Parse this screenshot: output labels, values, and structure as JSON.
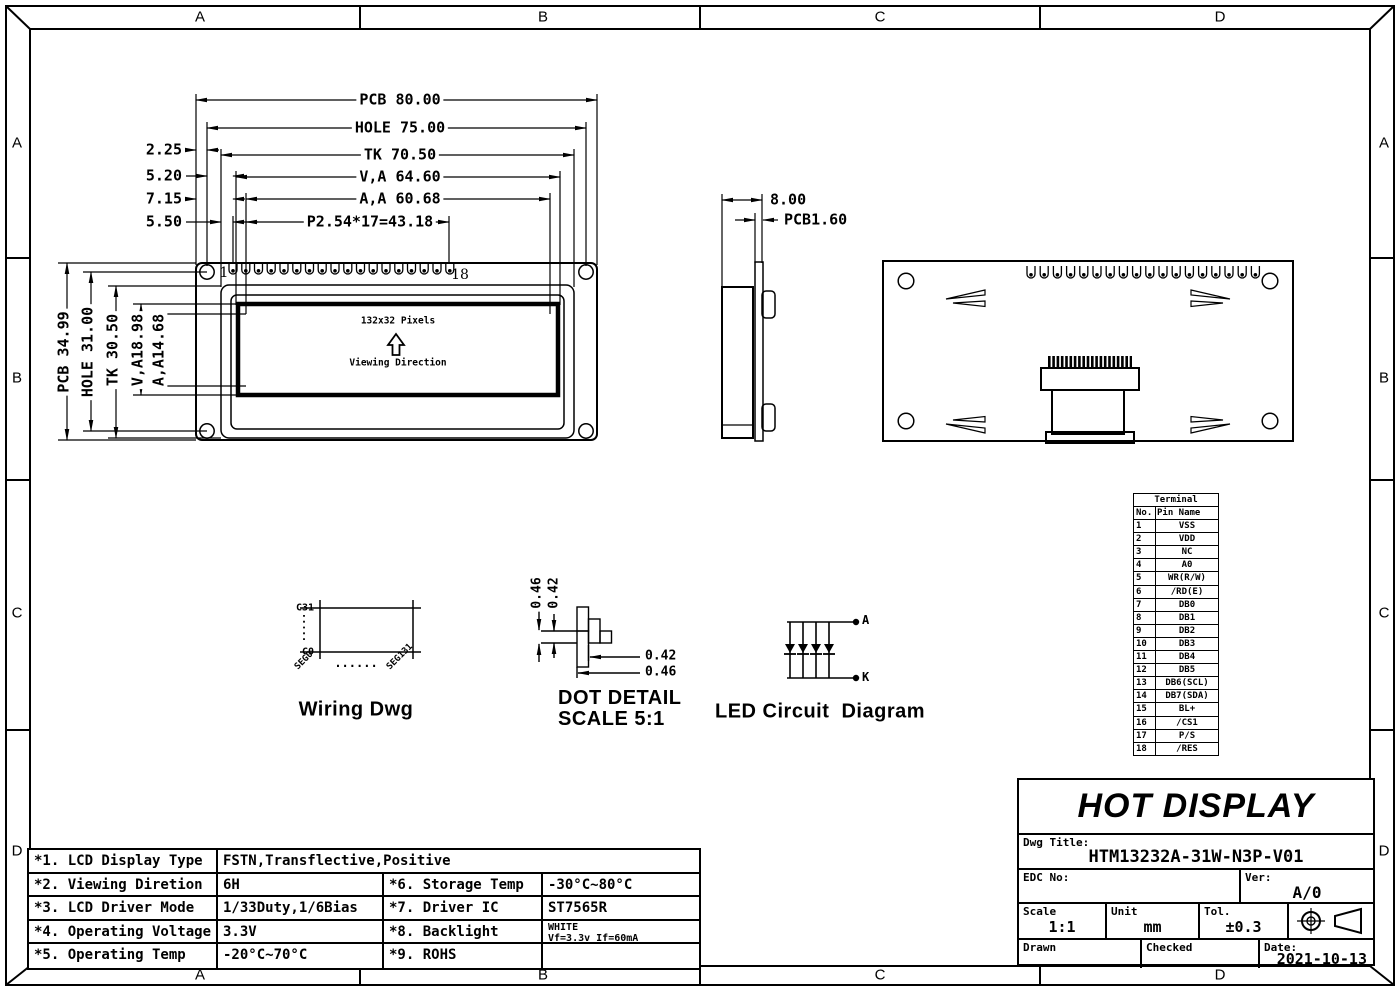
{
  "zones": {
    "top": [
      "A",
      "B",
      "C",
      "D"
    ],
    "bottom": [
      "A",
      "B",
      "C",
      "D"
    ],
    "left": [
      "A",
      "B",
      "C",
      "D"
    ],
    "right": [
      "A",
      "B",
      "C",
      "D"
    ]
  },
  "front_view": {
    "dim_pcb_w": "PCB 80.00",
    "dim_hole_w": "HOLE 75.00",
    "dim_tk_w": "TK 70.50",
    "dim_va_w": "V,A 64.60",
    "dim_aa_w": "A,A 60.68",
    "dim_pitch": "P2.54*17=43.18",
    "offset_1": "2.25",
    "offset_2": "5.20",
    "offset_3": "7.15",
    "offset_4": "5.50",
    "dim_pcb_h": "PCB 34.99",
    "dim_hole_h": "HOLE 31.00",
    "dim_tk_h": "TK 30.50",
    "dim_va_h": "V,A18.98",
    "dim_aa_h": "A,A14.68",
    "pin_first": "1",
    "pin_last": "18",
    "display_label": "132x32 Pixels",
    "viewing_label": "Viewing Direction"
  },
  "side_view": {
    "dim_total": "8.00",
    "dim_pcb_t": "PCB1.60"
  },
  "terminal_table": {
    "title": "Terminal",
    "headers": [
      "No.",
      "Pin Name"
    ],
    "rows": [
      [
        "1",
        "VSS"
      ],
      [
        "2",
        "VDD"
      ],
      [
        "3",
        "NC"
      ],
      [
        "4",
        "A0"
      ],
      [
        "5",
        "WR(R/W)"
      ],
      [
        "6",
        "/RD(E)"
      ],
      [
        "7",
        "DB0"
      ],
      [
        "8",
        "DB1"
      ],
      [
        "9",
        "DB2"
      ],
      [
        "10",
        "DB3"
      ],
      [
        "11",
        "DB4"
      ],
      [
        "12",
        "DB5"
      ],
      [
        "13",
        "DB6(SCL)"
      ],
      [
        "14",
        "DB7(SDA)"
      ],
      [
        "15",
        "BL+"
      ],
      [
        "16",
        "/CS1"
      ],
      [
        "17",
        "P/S"
      ],
      [
        "18",
        "/RES"
      ]
    ]
  },
  "wiring": {
    "title": "Wiring Dwg",
    "com_top": "C31",
    "com_bottom": "C0",
    "seg_left": "SEG0",
    "seg_right": "SEG131",
    "dots": "......"
  },
  "dot_detail": {
    "title": "DOT DETAIL",
    "scale": "SCALE 5:1",
    "v1": "0.46",
    "v2": "0.42",
    "h1": "0.42",
    "h2": "0.46"
  },
  "led_circuit": {
    "title": "LED Circuit  Diagram",
    "anode": "A",
    "cathode": "K"
  },
  "spec_table": {
    "r1_label": "*1. LCD Display Type",
    "r1_value": "FSTN,Transflective,Positive",
    "rows": [
      {
        "c1": "*2. Viewing Diretion",
        "c2": "6H",
        "c3": "*6. Storage Temp",
        "c4": "-30°C~80°C"
      },
      {
        "c1": "*3. LCD Driver Mode",
        "c2": "1/33Duty,1/6Bias",
        "c3": "*7. Driver IC",
        "c4": "ST7565R"
      },
      {
        "c1": "*4. Operating Voltage",
        "c2": "3.3V",
        "c3": "*8. Backlight",
        "c4": "WHITE",
        "c4b": "Vf=3.3v If=60mA"
      },
      {
        "c1": "*5. Operating Temp",
        "c2": "-20°C~70°C",
        "c3": "*9. ROHS",
        "c4": ""
      }
    ]
  },
  "title_block": {
    "company": "HOT DISPLAY",
    "dwg_title_label": "Dwg Title:",
    "dwg_title": "HTM13232A-31W-N3P-V01",
    "edc_label": "EDC No:",
    "ver_label": "Ver:",
    "ver": "A/0",
    "scale_label": "Scale",
    "scale": "1:1",
    "unit_label": "Unit",
    "unit": "mm",
    "tol_label": "Tol.",
    "tol": "±0.3",
    "drawn_label": "Drawn",
    "checked_label": "Checked",
    "date_label": "Date:",
    "date": "2021-10-13"
  }
}
